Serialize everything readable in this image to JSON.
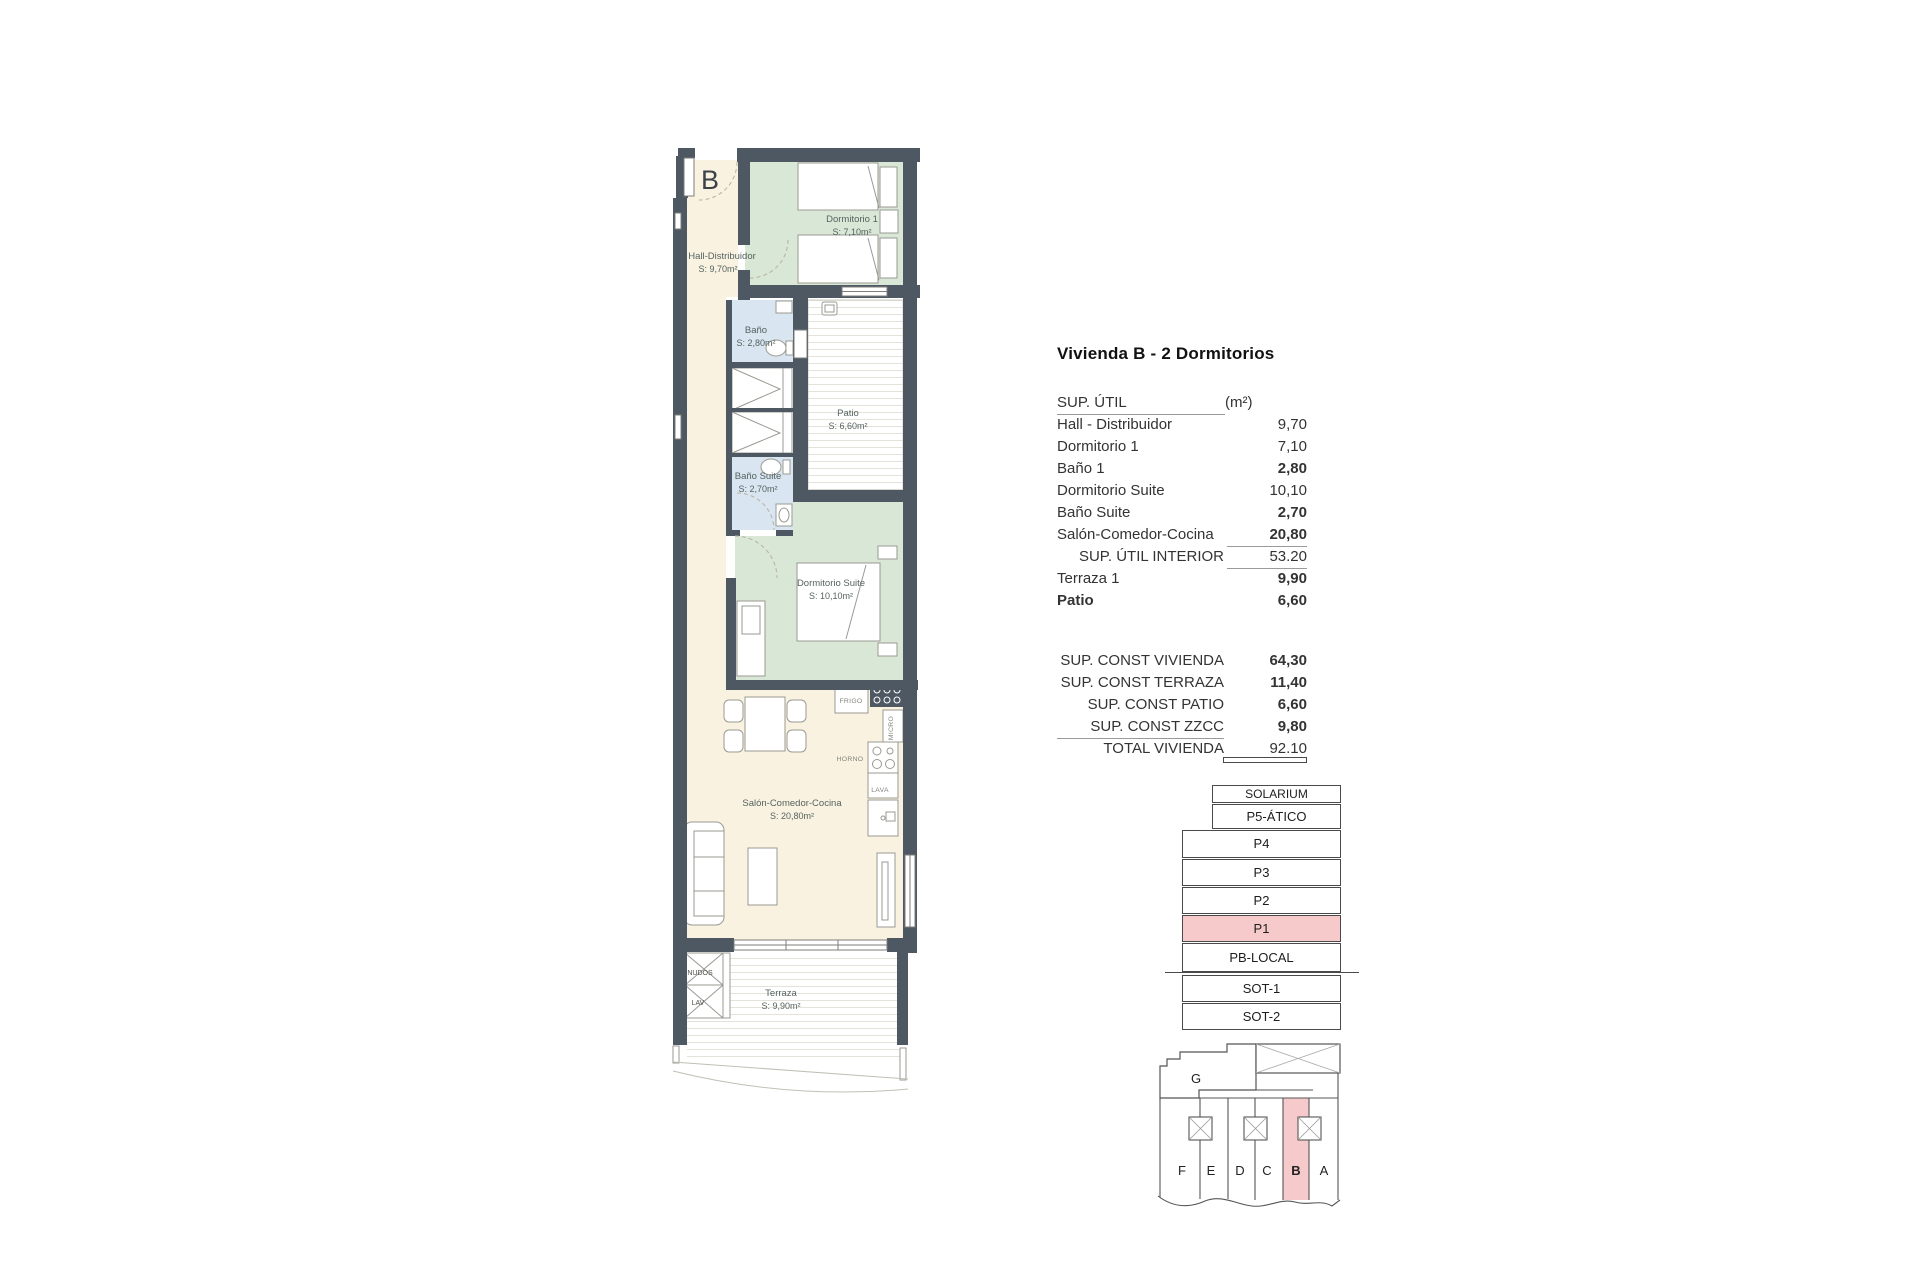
{
  "panel": {
    "title": "Vivienda B - 2 Dormitorios",
    "sup_util": {
      "header": "SUP. ÚTIL",
      "unit": "(m²)",
      "rows": [
        {
          "label": "Hall - Distribuidor",
          "value": "9,70"
        },
        {
          "label": "Dormitorio 1",
          "value": "7,10"
        },
        {
          "label": "Baño 1",
          "value": "2,80"
        },
        {
          "label": "Dormitorio Suite",
          "value": "10,10"
        },
        {
          "label": "Baño Suite",
          "value": "2,70"
        },
        {
          "label": "Salón-Comedor-Cocina",
          "value": "20,80"
        }
      ],
      "subtotal": {
        "label": "SUP. ÚTIL INTERIOR",
        "value": "53.20"
      },
      "outdoor_rows": [
        {
          "label": "Terraza 1",
          "value": "9,90"
        },
        {
          "label": "Patio",
          "value": "6,60"
        }
      ]
    },
    "sup_const": {
      "rows": [
        {
          "label": "SUP. CONST VIVIENDA",
          "value": "64,30"
        },
        {
          "label": "SUP. CONST TERRAZA",
          "value": "11,40"
        },
        {
          "label": "SUP. CONST PATIO",
          "value": "6,60"
        },
        {
          "label": "SUP. CONST ZZCC",
          "value": "9,80"
        }
      ],
      "total": {
        "label": "TOTAL VIVIENDA",
        "value": "92.10"
      }
    }
  },
  "floor_stack": {
    "levels": [
      {
        "label": "SOLARIUM"
      },
      {
        "label": "P5-ÁTICO"
      },
      {
        "label": "P4"
      },
      {
        "label": "P3"
      },
      {
        "label": "P2"
      },
      {
        "label": "P1"
      },
      {
        "label": "PB-LOCAL"
      },
      {
        "label": "SOT-1"
      },
      {
        "label": "SOT-2"
      }
    ],
    "highlighted_level": "P1"
  },
  "key_plan": {
    "roof_label": "G",
    "units": [
      {
        "letter": "F"
      },
      {
        "letter": "E"
      },
      {
        "letter": "D"
      },
      {
        "letter": "C"
      },
      {
        "letter": "B"
      },
      {
        "letter": "A"
      }
    ],
    "highlighted_unit": "B"
  },
  "floor_plan": {
    "unit_letter": "B",
    "rooms": [
      {
        "name": "Hall-Distribuidor",
        "area": "S: 9,70m²"
      },
      {
        "name": "Dormitorio 1",
        "area": "S: 7,10m²"
      },
      {
        "name": "Baño",
        "area": "S: 2,80m²"
      },
      {
        "name": "Patio",
        "area": "S: 6,60m²"
      },
      {
        "name": "Baño Suite",
        "area": "S: 2,70m²"
      },
      {
        "name": "Dormitorio Suite",
        "area": "S: 10,10m²"
      },
      {
        "name": "Salón-Comedor-Cocina",
        "area": "S: 20,80m²"
      },
      {
        "name": "Terraza",
        "area": "S: 9,90m²"
      }
    ],
    "appliances": [
      {
        "label": "FRIGO"
      },
      {
        "label": "MICRO"
      },
      {
        "label": "HORNO"
      },
      {
        "label": "LAVA"
      }
    ],
    "utility": [
      {
        "label": "NUDOS"
      },
      {
        "label": "LAV"
      }
    ]
  },
  "colors": {
    "wall": "#4d5863",
    "room_cream": "#f9f2e1",
    "room_green": "#d9e7d6",
    "room_blue": "#d9e5f1",
    "highlight_pink": "#f6caca",
    "line": "#4a4a4a"
  }
}
